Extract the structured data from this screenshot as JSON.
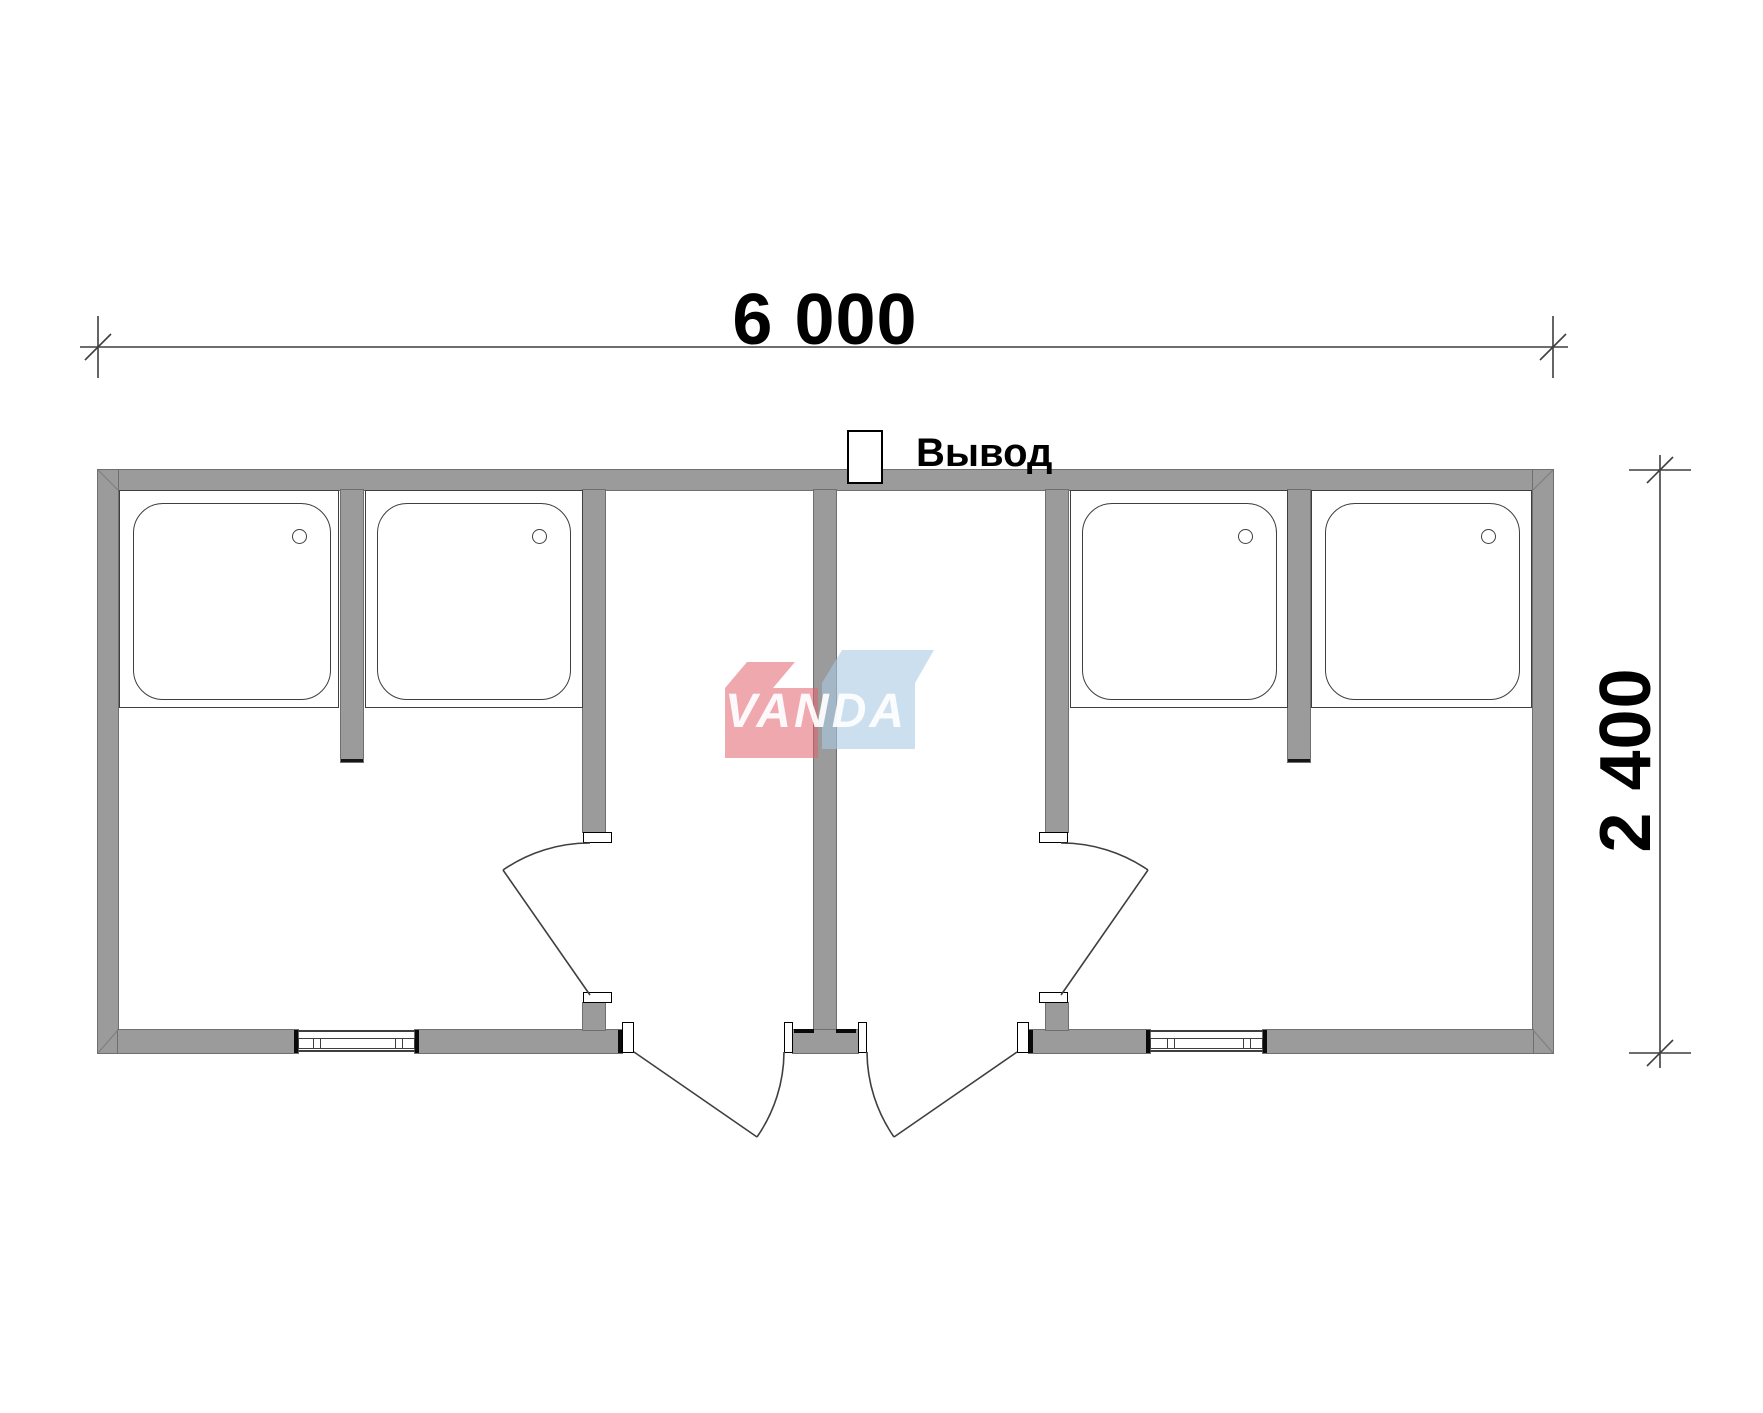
{
  "drawing": {
    "type": "floor-plan",
    "top_dimension": "6 000",
    "side_dimension": "2 400",
    "outlet_label": "Вывод",
    "watermark_text": "VANDA",
    "shower_tray_count": 4,
    "entrance_door_count": 2,
    "window_count": 2
  },
  "colors": {
    "background": "#ffffff",
    "wall_fill": "#9b9b9b",
    "wall_edge": "#6f6f6f",
    "line": "#3f3f3f",
    "cut_mark": "#0a0a0a",
    "watermark_red": "#e4606e",
    "watermark_blue": "#a9c9e5",
    "watermark_text_color": "#ffffff"
  }
}
